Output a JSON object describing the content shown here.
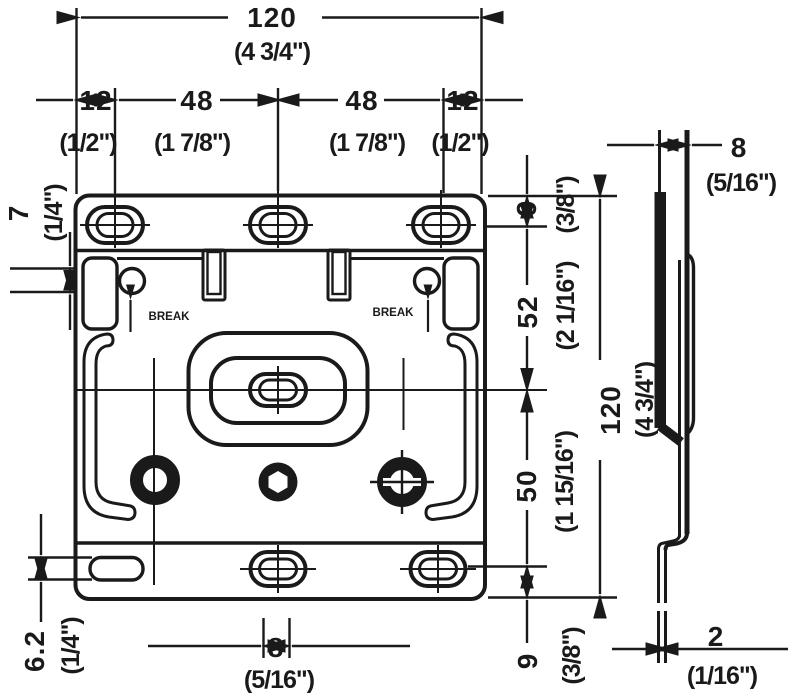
{
  "front_view": {
    "width": {
      "mm": "120",
      "in": "(4 3/4\")"
    },
    "width_segments": [
      {
        "mm": "12",
        "in": "(1/2\")"
      },
      {
        "mm": "48",
        "in": "(1 7/8\")"
      },
      {
        "mm": "48",
        "in": "(1 7/8\")"
      },
      {
        "mm": "12",
        "in": "(1/2\")"
      }
    ],
    "hole_diameter": {
      "mm": "7",
      "in": "(1/4\")"
    },
    "top_slot_offset": {
      "mm": "9",
      "in": "(3/8\")"
    },
    "upper_span": {
      "mm": "52",
      "in": "(2 1/16\")"
    },
    "lower_span": {
      "mm": "50",
      "in": "(1 15/16\")"
    },
    "bottom_slot_offset": {
      "mm": "9",
      "in": "(3/8\")"
    },
    "height": {
      "mm": "120",
      "in": "(4 3/4\")"
    },
    "bottom_left_slot_height": {
      "mm": "6.2",
      "in": "(1/4\")"
    },
    "bottom_slot_width": {
      "mm": "8",
      "in": "(5/16\")"
    },
    "knockout_label_left": "BREAK",
    "knockout_label_right": "BREAK"
  },
  "side_view": {
    "depth": {
      "mm": "8",
      "in": "(5/16\")"
    },
    "thickness": {
      "mm": "2",
      "in": "(1/16\")"
    }
  }
}
